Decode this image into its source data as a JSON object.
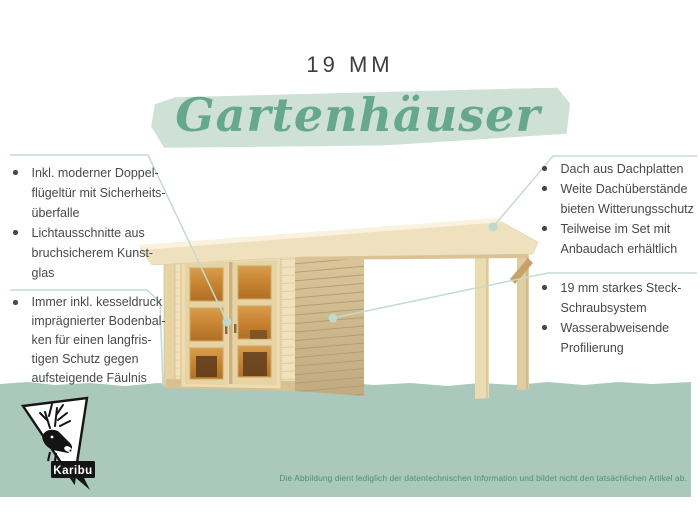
{
  "header": {
    "thickness": "19 MM",
    "category": "Gartenhäuser"
  },
  "features": {
    "left_top": [
      {
        "lines": [
          "Inkl. moderner Doppel-",
          "flügeltür mit Sicherheits-",
          "überfalle"
        ]
      },
      {
        "lines": [
          "Lichtausschnitte aus",
          "bruchsicherem Kunst-",
          "glas"
        ]
      }
    ],
    "left_bottom": [
      {
        "lines": [
          "Immer inkl. kesseldruck",
          "imprägnierter Bodenbal-",
          "ken für einen langfris-",
          "tigen Schutz gegen",
          "aufsteigende Fäulnis"
        ]
      }
    ],
    "right_top": [
      {
        "lines": [
          "Dach aus Dachplatten"
        ]
      },
      {
        "lines": [
          "Weite Dachüberstände",
          "bieten Witterungsschutz"
        ]
      },
      {
        "lines": [
          "Teilweise im Set mit",
          "Anbaudach erhältlich"
        ]
      }
    ],
    "right_bottom": [
      {
        "lines": [
          "19 mm starkes Steck-",
          "Schraubsystem"
        ]
      },
      {
        "lines": [
          "Wasserabweisende",
          "Profilierung"
        ]
      }
    ]
  },
  "illustration": {
    "name": "gartenhaus-mit-anbaudach",
    "callouts": [
      "door",
      "roof-corner",
      "side-wall",
      "floor-beams"
    ]
  },
  "footer": {
    "brand": "Karibu",
    "disclaimer": "Die Abbildung dient lediglich der datentechnischen Information und bildet nicht den tatsächlichen Artikel ab."
  },
  "colors": {
    "accent_green": "#67a78e",
    "brush_green": "#cfe1d7",
    "band_green": "#aac8bb",
    "leader_line": "#c3dccf",
    "text_dark": "#45494c",
    "disclaimer_green": "#4e8e7c",
    "wood_light": "#f1e2bd",
    "wood_side": "#cdb689",
    "glass_amber": "#c5812f"
  }
}
